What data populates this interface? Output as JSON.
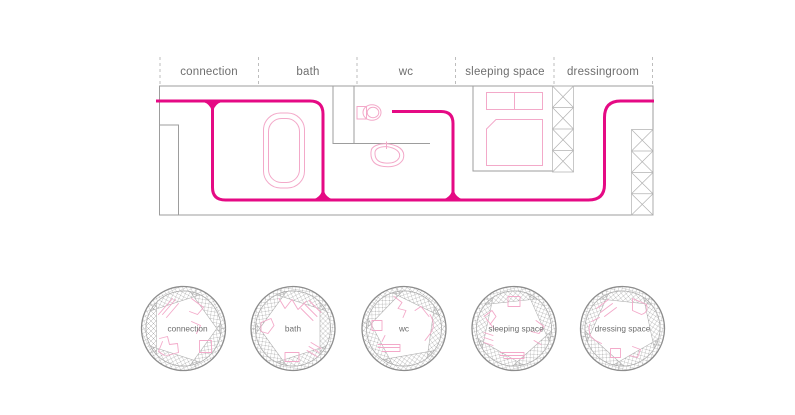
{
  "plan": {
    "sections": [
      {
        "label": "connection"
      },
      {
        "label": "bath"
      },
      {
        "label": "wc"
      },
      {
        "label": "sleeping space"
      },
      {
        "label": "dressingroom"
      }
    ],
    "furniture": [
      "bathtub",
      "toilet",
      "sink",
      "bed"
    ]
  },
  "tubes": [
    {
      "label": "connection"
    },
    {
      "label": "bath"
    },
    {
      "label": "wc"
    },
    {
      "label": "sleeping space"
    },
    {
      "label": "dressing space"
    }
  ],
  "colors": {
    "route": "#e50a84",
    "furniture": "#f3a9c9",
    "wall": "#9d9d9d",
    "hatch": "#b2b2b2",
    "label": "#6e6e6e"
  }
}
